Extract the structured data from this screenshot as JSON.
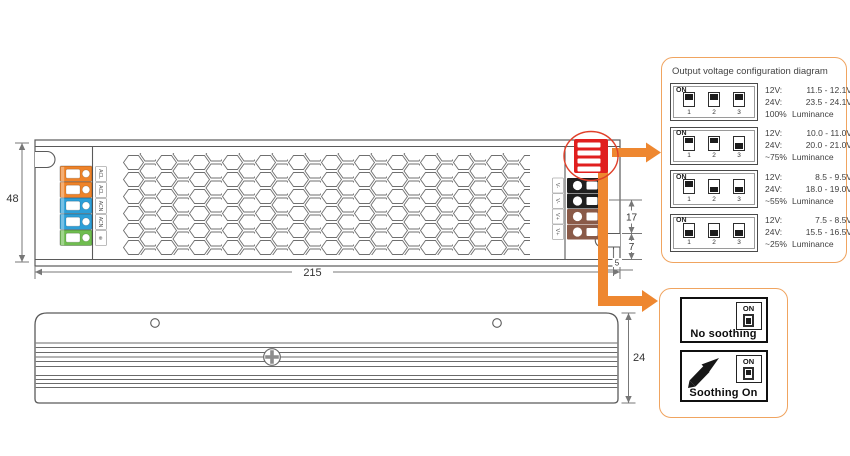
{
  "colors": {
    "accent_orange": "#ee8730",
    "panel_border": "#f0a460",
    "dip_red": "#e01f1f",
    "dip_ellipse": "#e0402a",
    "terminal_orange": "#ef8329",
    "terminal_blue": "#2d9fd8",
    "terminal_green": "#6fbd4f",
    "terminal_black": "#1f1f1f",
    "terminal_brown": "#8a5a48"
  },
  "top_view": {
    "dims": {
      "width": "215",
      "height": "48",
      "d17": "17",
      "d7": "7",
      "d5": "5"
    },
    "input_labels": [
      "ACL",
      "ACL",
      "ACN",
      "ACN",
      "⊕"
    ],
    "output_labels": [
      "V-",
      "V-",
      "V+",
      "V+"
    ]
  },
  "side_view": {
    "dims": {
      "height": "24"
    }
  },
  "config_panel": {
    "title": "Output voltage configuration diagram",
    "on_label": "ON",
    "switch_labels": [
      "1",
      "2",
      "3"
    ],
    "rows": [
      {
        "switches": [
          "on",
          "on",
          "on"
        ],
        "l1": [
          "12V:",
          "11.5 - 12.1V"
        ],
        "l2": [
          "24V:",
          "23.5 - 24.1V"
        ],
        "l3": [
          "100%",
          "Luminance"
        ]
      },
      {
        "switches": [
          "on",
          "on",
          "off"
        ],
        "l1": [
          "12V:",
          "10.0 - 11.0V"
        ],
        "l2": [
          "24V:",
          "20.0 - 21.0V"
        ],
        "l3": [
          "~75%",
          "Luminance"
        ]
      },
      {
        "switches": [
          "on",
          "off",
          "off"
        ],
        "l1": [
          "12V:",
          "8.5 - 9.5V"
        ],
        "l2": [
          "24V:",
          "18.0 - 19.0V"
        ],
        "l3": [
          "~55%",
          "Luminance"
        ]
      },
      {
        "switches": [
          "off",
          "off",
          "off"
        ],
        "l1": [
          "12V:",
          "7.5 - 8.5V"
        ],
        "l2": [
          "24V:",
          "15.5 - 16.5V"
        ],
        "l3": [
          "~25%",
          "Luminance"
        ]
      }
    ]
  },
  "soothing_panel": {
    "items": [
      {
        "label": "No soothing",
        "on_label": "ON",
        "switch": "off"
      },
      {
        "label": "Soothing On",
        "on_label": "ON",
        "switch": "on"
      }
    ]
  }
}
